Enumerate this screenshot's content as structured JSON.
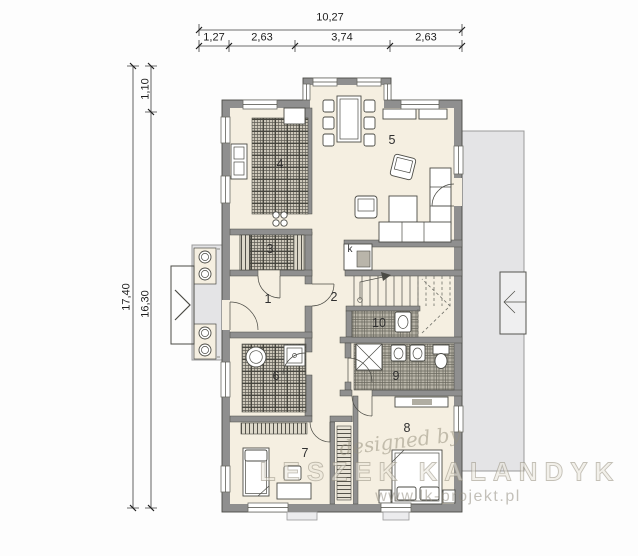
{
  "dimensions": {
    "top": {
      "total": "10,27",
      "segments": [
        "1,27",
        "2,63",
        "3,74",
        "2,63"
      ]
    },
    "left": {
      "total": "17,40",
      "inner": "16,30",
      "top_offset": "1,10"
    }
  },
  "rooms": [
    {
      "label": "1"
    },
    {
      "label": "2"
    },
    {
      "label": "3"
    },
    {
      "label": "4"
    },
    {
      "label": "5"
    },
    {
      "label": "6"
    },
    {
      "label": "7"
    },
    {
      "label": "8"
    },
    {
      "label": "9"
    },
    {
      "label": "10"
    }
  ],
  "fireplace": {
    "label": "k"
  },
  "watermark": {
    "designed_by": "designed by",
    "studio": "LESZEK KALANDYK",
    "website": "www.lk-projekt.pl"
  },
  "colors": {
    "wall": "#8f8f8f",
    "floor": "#f5efe1",
    "paving": "#e4e4e6",
    "hatch_line": "#5f5d55"
  }
}
